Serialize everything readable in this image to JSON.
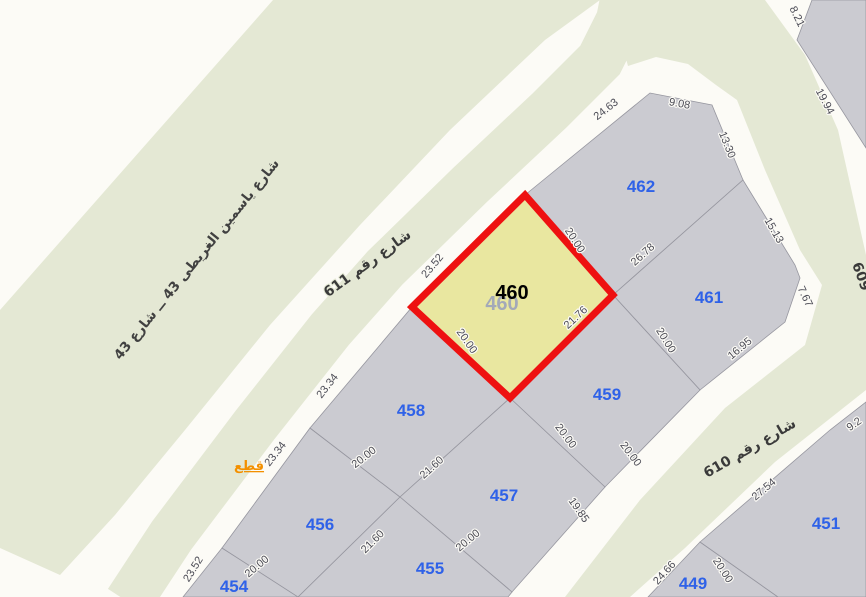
{
  "map": {
    "parcels": {
      "p449": "449",
      "p451": "451",
      "p454": "454",
      "p455": "455",
      "p456": "456",
      "p457": "457",
      "p458": "458",
      "p459": "459",
      "p461": "461",
      "p462": "462",
      "highlighted": {
        "number": "460",
        "ghost": "460"
      }
    },
    "dimensions": [
      "8.21",
      "19.94",
      "24.63",
      "9.08",
      "13.30",
      "15.13",
      "23.52",
      "20.00",
      "26.78",
      "7.67",
      "16.95",
      "20.00",
      "21.76",
      "20.00",
      "23.34",
      "23.34",
      "20.00",
      "21.60",
      "20.00",
      "20.00",
      "19.85",
      "20.00",
      "21.60",
      "20.00",
      "23.52",
      "27.54",
      "9.2",
      "24.66",
      "20.00"
    ],
    "streets": {
      "s611": "شارع رقم 611",
      "s610": "شارع رقم 610",
      "s43": "شارع ياسمين الغريطى 43 ــ شارع 43",
      "s609": "609"
    },
    "link_label": "قطع",
    "colors": {
      "highlight_fill": "#e9e7a0",
      "highlight_border": "#ee1111",
      "parcel_fill": "#cbcbd1",
      "road_white": "#fcfbf6",
      "green_area": "#e4e8d4",
      "parcel_number_blue": "#2f62e8",
      "dimension_gray": "#4b4b55",
      "link_orange": "#f39000"
    }
  }
}
